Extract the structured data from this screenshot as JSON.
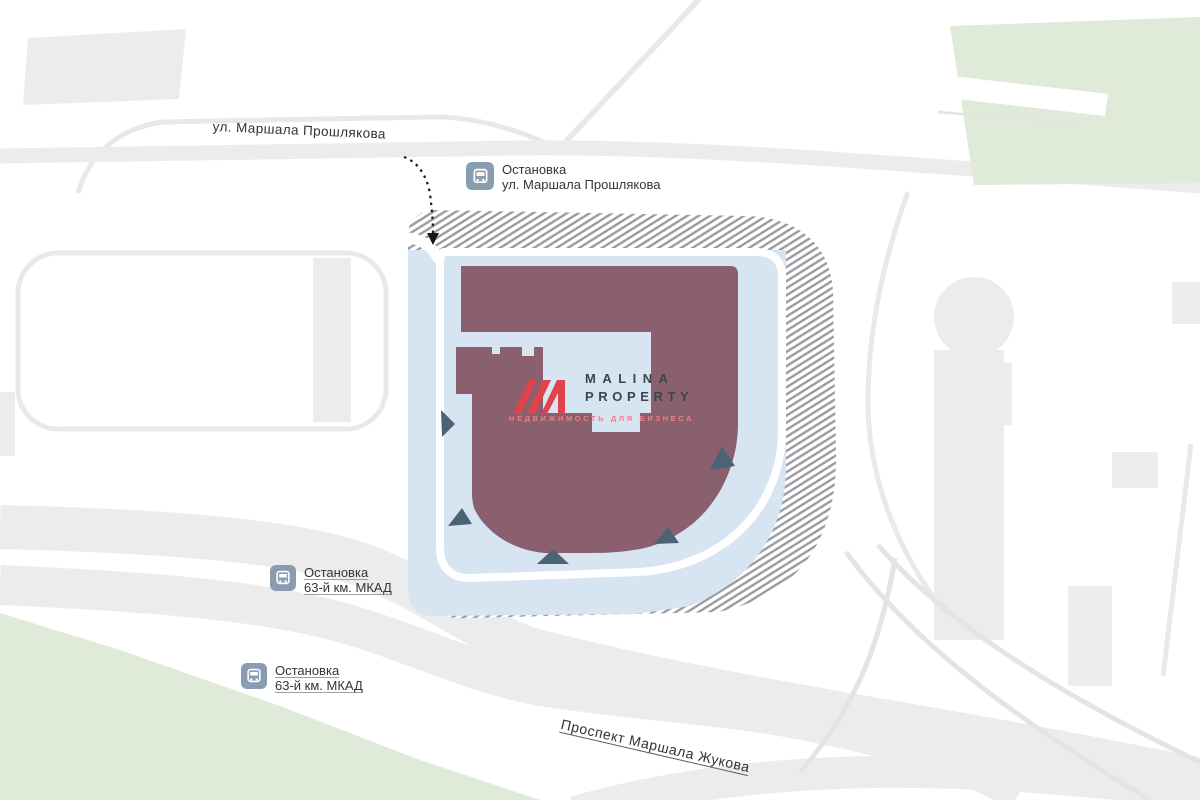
{
  "streets": {
    "top": "ул. Маршала Прошлякова",
    "bottom": "Проспект Маршала Жукова"
  },
  "stops": {
    "top": {
      "line1": "Остановка",
      "line2": "ул. Маршала Прошлякова"
    },
    "mid": {
      "line1": "Остановка",
      "line2": "63-й км. МКАД"
    },
    "bottom": {
      "line1": "Остановка",
      "line2": "63-й км. МКАД"
    }
  },
  "logo": {
    "line1": "MALINA",
    "line2": "PROPERTY",
    "tagline": "НЕДВИЖИМОСТЬ ДЛЯ БИЗНЕСА"
  },
  "colors": {
    "building": "#8a5f6e",
    "territory": "#d7e4f2",
    "hatch_stripe": "#9b9ba0",
    "road": "#ececec",
    "road_line": "#e8e8e8",
    "green": "#dfead9",
    "arrow_slate": "#4c6374",
    "bus_icon": "#8a9cb2",
    "logo_red": "#e2434b",
    "logo_dark": "#3d444e",
    "tagline_red": "#ea8086",
    "text": "#2e3338"
  }
}
